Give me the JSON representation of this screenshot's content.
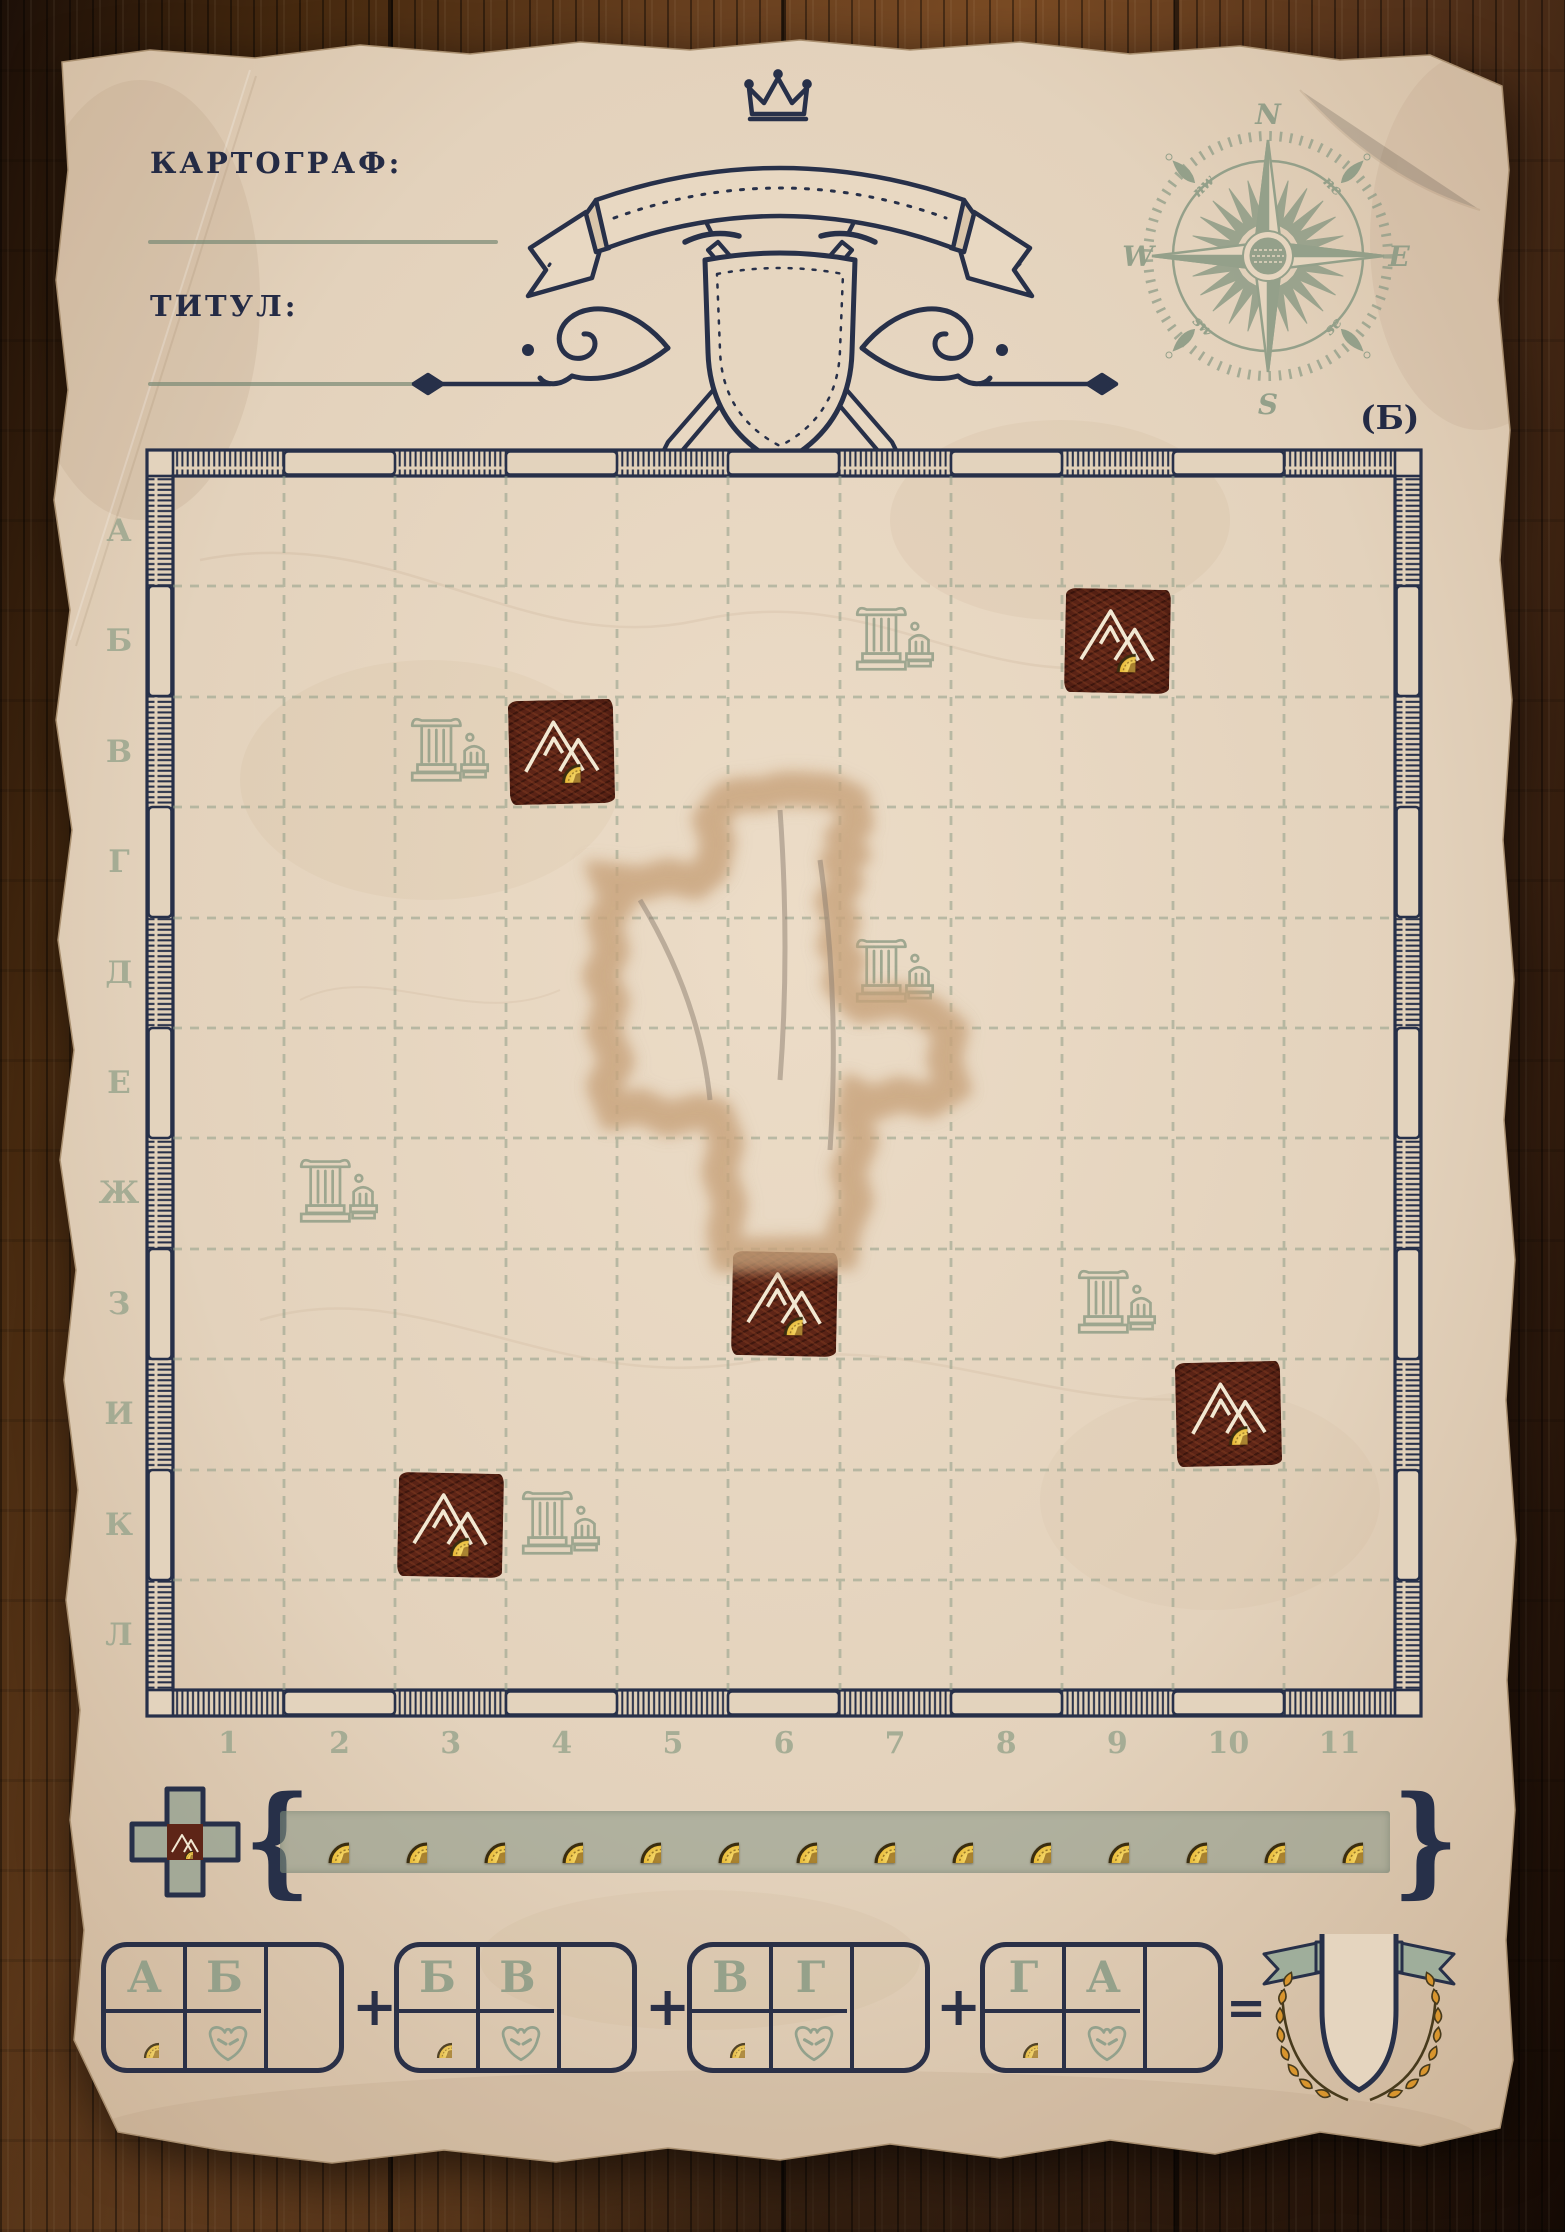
{
  "header": {
    "cartographer_label": "КАРТОГРАФ:",
    "title_label": "ТИТУЛ:",
    "side_label": "(Б)"
  },
  "compass": {
    "n": "N",
    "e": "E",
    "s": "S",
    "w": "W",
    "nw": "nw",
    "ne": "ne",
    "sw": "sw",
    "se": "se"
  },
  "grid": {
    "row_labels": [
      "А",
      "Б",
      "В",
      "Г",
      "Д",
      "Е",
      "Ж",
      "З",
      "И",
      "К",
      "Л"
    ],
    "col_labels": [
      "1",
      "2",
      "3",
      "4",
      "5",
      "6",
      "7",
      "8",
      "9",
      "10",
      "11"
    ]
  },
  "board": {
    "mountains": [
      {
        "row": 1,
        "col": 8
      },
      {
        "row": 2,
        "col": 3
      },
      {
        "row": 7,
        "col": 5
      },
      {
        "row": 8,
        "col": 9
      },
      {
        "row": 9,
        "col": 2
      }
    ],
    "ruins": [
      {
        "row": 1,
        "col": 6
      },
      {
        "row": 2,
        "col": 2
      },
      {
        "row": 4,
        "col": 6
      },
      {
        "row": 6,
        "col": 1
      },
      {
        "row": 7,
        "col": 8
      },
      {
        "row": 9,
        "col": 3
      }
    ]
  },
  "legend": {
    "coin_count": 14,
    "brace_left": "{",
    "brace_right": "}"
  },
  "scoring": {
    "boxes": [
      {
        "letters": [
          "А",
          "Б"
        ]
      },
      {
        "letters": [
          "Б",
          "В"
        ]
      },
      {
        "letters": [
          "В",
          "Г"
        ]
      },
      {
        "letters": [
          "Г",
          "А"
        ]
      }
    ],
    "plus_label": "+",
    "equals_label": "="
  },
  "colors": {
    "ink_navy": "#242b45",
    "sage_green": "#8e9d87",
    "mountain_brown": "#5e2517",
    "coin_gold": "#e6b42e",
    "paper": "#e3d2bc",
    "hole_gray": "#a79a8d"
  }
}
